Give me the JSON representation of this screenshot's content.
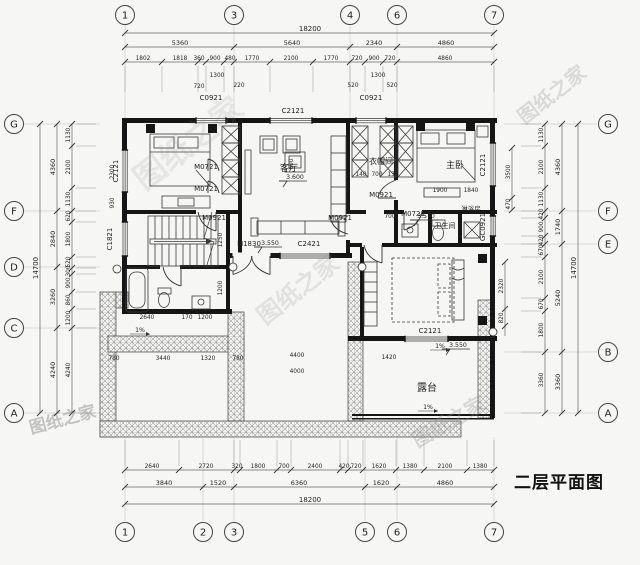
{
  "title": {
    "text": "二层平面图"
  },
  "colors": {
    "bg": "#f6f6f4",
    "wall": "#161616",
    "dim": "#666666",
    "text": "#222222",
    "watermark": "#8f8f8f"
  },
  "watermarks": [
    {
      "text": "图纸之家",
      "x": 195,
      "y": 152,
      "rot": -38,
      "size": 32,
      "op": 0.16
    },
    {
      "text": "图纸之家",
      "x": 556,
      "y": 100,
      "rot": -38,
      "size": 20,
      "op": 0.28
    },
    {
      "text": "图纸之家",
      "x": 303,
      "y": 296,
      "rot": -38,
      "size": 24,
      "op": 0.2
    },
    {
      "text": "图纸之家",
      "x": 64,
      "y": 425,
      "rot": -15,
      "size": 17,
      "op": 0.5
    },
    {
      "text": "图纸之家",
      "x": 452,
      "y": 428,
      "rot": -30,
      "size": 20,
      "op": 0.3
    }
  ],
  "grid": [
    {
      "l": "1",
      "x": 125,
      "y": 15
    },
    {
      "l": "3",
      "x": 234,
      "y": 15
    },
    {
      "l": "4",
      "x": 350,
      "y": 15
    },
    {
      "l": "6",
      "x": 397,
      "y": 15
    },
    {
      "l": "7",
      "x": 494,
      "y": 15
    },
    {
      "l": "1",
      "x": 125,
      "y": 532
    },
    {
      "l": "2",
      "x": 203,
      "y": 532
    },
    {
      "l": "3",
      "x": 234,
      "y": 532
    },
    {
      "l": "5",
      "x": 365,
      "y": 532
    },
    {
      "l": "6",
      "x": 397,
      "y": 532
    },
    {
      "l": "7",
      "x": 494,
      "y": 532
    },
    {
      "l": "G",
      "x": 14,
      "y": 124
    },
    {
      "l": "F",
      "x": 14,
      "y": 211
    },
    {
      "l": "D",
      "x": 14,
      "y": 267
    },
    {
      "l": "C",
      "x": 14,
      "y": 328
    },
    {
      "l": "A",
      "x": 14,
      "y": 413
    },
    {
      "l": "G",
      "x": 608,
      "y": 124
    },
    {
      "l": "F",
      "x": 608,
      "y": 211
    },
    {
      "l": "E",
      "x": 608,
      "y": 244
    },
    {
      "l": "B",
      "x": 608,
      "y": 352
    },
    {
      "l": "A",
      "x": 608,
      "y": 413
    }
  ],
  "dim_rows": [
    {
      "y": 33,
      "x1": 125,
      "x2": 494,
      "fs": 7,
      "ticks": [
        125,
        494
      ],
      "labels": [
        {
          "t": "18200",
          "c": 310
        }
      ]
    },
    {
      "y": 47,
      "x1": 125,
      "x2": 494,
      "fs": 6.5,
      "ticks": [
        125,
        234,
        350,
        397,
        494
      ],
      "labels": [
        {
          "t": "5360",
          "c": 180
        },
        {
          "t": "5640",
          "c": 292
        },
        {
          "t": "2340",
          "c": 374
        },
        {
          "t": "4860",
          "c": 446
        }
      ]
    },
    {
      "y": 62,
      "x1": 125,
      "x2": 494,
      "fs": 5.8,
      "ext": [
        4,
        30
      ],
      "ticks": [
        125,
        162,
        198,
        206,
        224,
        234,
        270,
        313,
        350,
        365,
        383,
        397,
        494
      ],
      "labels": [
        {
          "t": "1802",
          "c": 143
        },
        {
          "t": "1818",
          "c": 180
        },
        {
          "t": "360",
          "c": 199
        },
        {
          "t": "900",
          "c": 215
        },
        {
          "t": "480",
          "c": 230
        },
        {
          "t": "1770",
          "c": 252
        },
        {
          "t": "2100",
          "c": 291
        },
        {
          "t": "1770",
          "c": 331
        },
        {
          "t": "720",
          "c": 357
        },
        {
          "t": "900",
          "c": 374
        },
        {
          "t": "720",
          "c": 390
        },
        {
          "t": "4860",
          "c": 445
        }
      ]
    },
    {
      "y": 470,
      "x1": 125,
      "x2": 494,
      "fs": 5.8,
      "ext": [
        -4,
        -30
      ],
      "ticks": [
        125,
        179,
        234,
        240,
        277,
        291,
        340,
        348,
        363,
        396,
        424,
        467,
        494
      ],
      "labels": [
        {
          "t": "2640",
          "c": 152
        },
        {
          "t": "2720",
          "c": 206
        },
        {
          "t": "320",
          "c": 237
        },
        {
          "t": "1800",
          "c": 258
        },
        {
          "t": "700",
          "c": 284
        },
        {
          "t": "2400",
          "c": 315
        },
        {
          "t": "420",
          "c": 344
        },
        {
          "t": "720",
          "c": 356
        },
        {
          "t": "1620",
          "c": 379
        },
        {
          "t": "1380",
          "c": 410
        },
        {
          "t": "2100",
          "c": 445
        },
        {
          "t": "1380",
          "c": 480
        }
      ]
    },
    {
      "y": 487,
      "x1": 125,
      "x2": 494,
      "fs": 6.5,
      "ticks": [
        125,
        203,
        234,
        365,
        397,
        494
      ],
      "labels": [
        {
          "t": "3840",
          "c": 164
        },
        {
          "t": "1520",
          "c": 218
        },
        {
          "t": "6360",
          "c": 299
        },
        {
          "t": "1620",
          "c": 381
        },
        {
          "t": "4860",
          "c": 445
        }
      ]
    },
    {
      "y": 504,
      "x1": 125,
      "x2": 494,
      "fs": 7,
      "ticks": [
        125,
        494
      ],
      "labels": [
        {
          "t": "18200",
          "c": 310
        }
      ]
    }
  ],
  "dim_cols": [
    {
      "x": 40,
      "y1": 124,
      "y2": 413,
      "fs": 7,
      "ticks": [
        124,
        413
      ],
      "labels": [
        {
          "t": "14700",
          "c": 268
        }
      ]
    },
    {
      "x": 57,
      "y1": 124,
      "y2": 413,
      "fs": 6.5,
      "ticks": [
        124,
        211,
        267,
        328,
        413
      ],
      "labels": [
        {
          "t": "4360",
          "c": 167
        },
        {
          "t": "2840",
          "c": 239
        },
        {
          "t": "3260",
          "c": 297
        },
        {
          "t": "4240",
          "c": 370
        }
      ]
    },
    {
      "x": 72,
      "y1": 124,
      "y2": 413,
      "fs": 5.8,
      "ext": [
        4,
        24
      ],
      "ticks": [
        124,
        146,
        188,
        211,
        222,
        257,
        268,
        274,
        292,
        309,
        328,
        413
      ],
      "labels": [
        {
          "t": "1130",
          "c": 135
        },
        {
          "t": "2100",
          "c": 167
        },
        {
          "t": "1130",
          "c": 199
        },
        {
          "t": "620",
          "c": 216
        },
        {
          "t": "1800",
          "c": 239
        },
        {
          "t": "520",
          "c": 262
        },
        {
          "t": "300",
          "c": 271
        },
        {
          "t": "900",
          "c": 283
        },
        {
          "t": "860",
          "c": 300
        },
        {
          "t": "1200",
          "c": 318
        },
        {
          "t": "4240",
          "c": 370
        }
      ]
    },
    {
      "x": 545,
      "y1": 124,
      "y2": 413,
      "fs": 5.8,
      "ext": [
        -4,
        -24
      ],
      "ticks": [
        124,
        146,
        188,
        211,
        218,
        236,
        244,
        257,
        298,
        311,
        352,
        413
      ],
      "labels": [
        {
          "t": "1130",
          "c": 135
        },
        {
          "t": "2100",
          "c": 167
        },
        {
          "t": "1130",
          "c": 199
        },
        {
          "t": "420",
          "c": 214
        },
        {
          "t": "900",
          "c": 227
        },
        {
          "t": "420",
          "c": 240
        },
        {
          "t": "670",
          "c": 250
        },
        {
          "t": "2100",
          "c": 277
        },
        {
          "t": "670",
          "c": 304
        },
        {
          "t": "1800",
          "c": 330
        },
        {
          "t": "3360",
          "c": 380
        }
      ]
    },
    {
      "x": 562,
      "y1": 124,
      "y2": 413,
      "fs": 6.5,
      "ticks": [
        124,
        211,
        244,
        352,
        413
      ],
      "labels": [
        {
          "t": "4360",
          "c": 167
        },
        {
          "t": "1740",
          "c": 227
        },
        {
          "t": "5240",
          "c": 298
        },
        {
          "t": "3360",
          "c": 382
        }
      ]
    },
    {
      "x": 578,
      "y1": 124,
      "y2": 413,
      "fs": 7,
      "ticks": [
        124,
        413
      ],
      "labels": [
        {
          "t": "14700",
          "c": 268
        }
      ]
    },
    {
      "x": 512,
      "y1": 148,
      "y2": 210,
      "fs": 5.8,
      "ticks": [
        148,
        198,
        210
      ],
      "labels": [
        {
          "t": "3500",
          "c": 172
        },
        {
          "t": "470",
          "c": 204
        }
      ]
    },
    {
      "x": 505,
      "y1": 262,
      "y2": 336,
      "fs": 5.8,
      "ticks": [
        262,
        309,
        326
      ],
      "labels": [
        {
          "t": "2320",
          "c": 286
        },
        {
          "t": "820",
          "c": 318
        }
      ]
    }
  ],
  "inline_dims": [
    {
      "t": "1300",
      "x": 217,
      "y": 77
    },
    {
      "t": "220",
      "x": 239,
      "y": 87
    },
    {
      "t": "720",
      "x": 199,
      "y": 88
    },
    {
      "t": "1300",
      "x": 378,
      "y": 77
    },
    {
      "t": "520",
      "x": 353,
      "y": 87
    },
    {
      "t": "520",
      "x": 392,
      "y": 87
    },
    {
      "t": "2300",
      "x": 114,
      "y": 172,
      "r": -90
    },
    {
      "t": "930",
      "x": 114,
      "y": 203,
      "r": -90
    },
    {
      "t": "1250",
      "x": 222,
      "y": 240,
      "r": -90
    },
    {
      "t": "1200",
      "x": 222,
      "y": 288,
      "r": -90
    },
    {
      "t": "600",
      "x": 293,
      "y": 164,
      "r": -90
    },
    {
      "t": "1900",
      "x": 440,
      "y": 192
    },
    {
      "t": "1840",
      "x": 471,
      "y": 192
    },
    {
      "t": "700",
      "x": 390,
      "y": 218
    },
    {
      "t": "140",
      "x": 361,
      "y": 176
    },
    {
      "t": "700",
      "x": 377,
      "y": 176
    },
    {
      "t": "135",
      "x": 393,
      "y": 176
    },
    {
      "t": "4400",
      "x": 297,
      "y": 357
    },
    {
      "t": "4000",
      "x": 297,
      "y": 373
    },
    {
      "t": "1420",
      "x": 389,
      "y": 359
    },
    {
      "t": "780",
      "x": 114,
      "y": 360
    },
    {
      "t": "3440",
      "x": 163,
      "y": 360
    },
    {
      "t": "1320",
      "x": 208,
      "y": 360
    },
    {
      "t": "780",
      "x": 238,
      "y": 360
    },
    {
      "t": "2640",
      "x": 147,
      "y": 319
    },
    {
      "t": "170",
      "x": 187,
      "y": 319
    },
    {
      "t": "1200",
      "x": 205,
      "y": 319
    }
  ],
  "opening_labels": [
    {
      "t": "C0921",
      "x": 211,
      "y": 100
    },
    {
      "t": "C2121",
      "x": 293,
      "y": 113
    },
    {
      "t": "C0921",
      "x": 371,
      "y": 100
    },
    {
      "t": "C2121",
      "x": 118,
      "y": 171,
      "r": -90
    },
    {
      "t": "C1821",
      "x": 112,
      "y": 239,
      "r": -90
    },
    {
      "t": "C2121",
      "x": 485,
      "y": 165,
      "r": -90
    },
    {
      "t": "GC0921",
      "x": 485,
      "y": 227,
      "r": -90
    },
    {
      "t": "C2421",
      "x": 309,
      "y": 246
    },
    {
      "t": "M1830",
      "x": 249,
      "y": 246
    },
    {
      "t": "C2121",
      "x": 430,
      "y": 333
    },
    {
      "t": "M0721",
      "x": 206,
      "y": 169
    },
    {
      "t": "M0721",
      "x": 206,
      "y": 191
    },
    {
      "t": "M0921",
      "x": 214,
      "y": 220
    },
    {
      "t": "M0921",
      "x": 340,
      "y": 220
    },
    {
      "t": "M0921",
      "x": 381,
      "y": 197
    },
    {
      "t": "M0721",
      "x": 413,
      "y": 216
    }
  ],
  "room_labels": [
    {
      "t": "客厅",
      "x": 289,
      "y": 171,
      "fs": 9
    },
    {
      "t": "衣帽间",
      "x": 381,
      "y": 164,
      "fs": 8
    },
    {
      "t": "主卧",
      "x": 455,
      "y": 168,
      "fs": 9
    },
    {
      "t": "卫生间",
      "x": 445,
      "y": 228,
      "fs": 7
    },
    {
      "t": "淋浴房",
      "x": 471,
      "y": 211,
      "fs": 6.5
    },
    {
      "t": "露台",
      "x": 427,
      "y": 391,
      "fs": 10
    }
  ],
  "elevations": [
    {
      "t": "3.600",
      "x": 283,
      "y": 186
    },
    {
      "t": "3.550",
      "x": 258,
      "y": 252
    },
    {
      "t": "3.570",
      "x": 414,
      "y": 225
    },
    {
      "t": "3.550",
      "x": 446,
      "y": 354
    }
  ],
  "slopes": [
    {
      "t": "1%",
      "x": 140,
      "y": 332
    },
    {
      "t": "1%",
      "x": 440,
      "y": 348
    },
    {
      "t": "1%",
      "x": 428,
      "y": 409
    }
  ]
}
